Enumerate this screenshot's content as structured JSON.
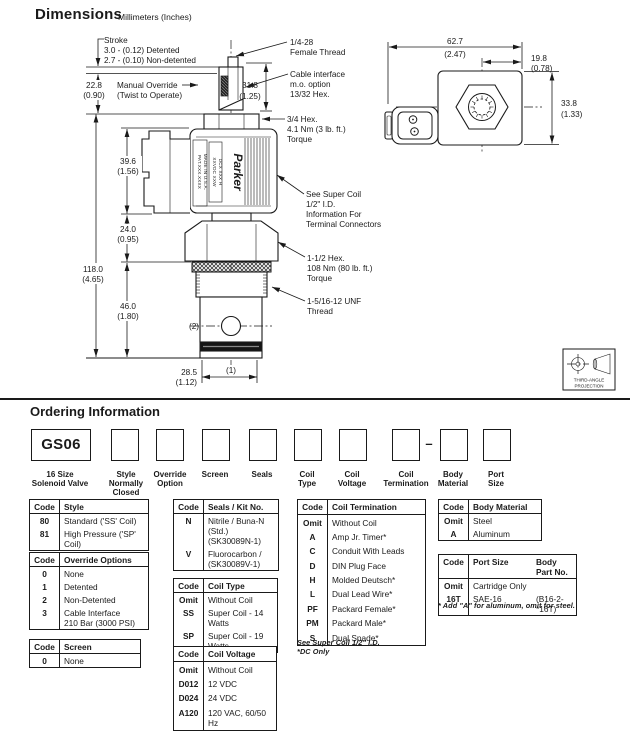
{
  "header": {
    "title": "Dimensions",
    "subtitle": "Millimeters (Inches)"
  },
  "diagram": {
    "stroke_lines": [
      "Stroke",
      "3.0 - (0.12) Detented",
      "2.7 - (0.10) Non-detented"
    ],
    "manual_override": [
      "Manual Override",
      "(Twist to Operate)"
    ],
    "dim_22_8": [
      "22.8",
      "(0.90)"
    ],
    "dim_118": [
      "118.0",
      "(4.65)"
    ],
    "dim_39_6": [
      "39.6",
      "(1.56)"
    ],
    "dim_24": [
      "24.0",
      "(0.95)"
    ],
    "dim_46": [
      "46.0",
      "(1.80)"
    ],
    "dim_31_8": [
      "31.8",
      "(1.25)"
    ],
    "dim_28_5": [
      "28.5",
      "(1.12)"
    ],
    "thread_callout": [
      "1/4-28",
      "Female Thread"
    ],
    "cable_callout": [
      "Cable interface",
      "m.o. option",
      "13/32 Hex."
    ],
    "hex34_callout": [
      "3/4 Hex.",
      "4.1 Nm (3 lb. ft.)",
      "Torque"
    ],
    "supercoil_callout": [
      "See Super Coil",
      "1/2\" I.D.",
      "Information For",
      "Terminal Connectors"
    ],
    "hex112_callout": [
      "1-1/2 Hex.",
      "108 Nm (80 lb. ft.)",
      "Torque"
    ],
    "unf_callout": [
      "1-5/16-12 UNF",
      "Thread"
    ],
    "port_1": "(1)",
    "port_2": "(2)",
    "coil_text": [
      "PAT.XXX.XXXX",
      "MADE IN U.S.A.",
      "XXVDC  XXW",
      "DCX XXX H"
    ],
    "brand": "Parker",
    "side_dim_62_7": [
      "62.7",
      "(2.47)"
    ],
    "side_dim_19_8": [
      "19.8",
      "(0.78)"
    ],
    "side_dim_33_8": [
      "33.8",
      "(1.33)"
    ],
    "projection": [
      "THIRD-ANGLE",
      "PROJECTION"
    ]
  },
  "ordering": {
    "title": "Ordering Information",
    "prefix": "GS06",
    "separator": "–",
    "fields": [
      {
        "lines": [
          "16 Size",
          "Solenoid Valve"
        ]
      },
      {
        "lines": [
          "Style",
          "Normally",
          "Closed"
        ]
      },
      {
        "lines": [
          "Override",
          "Option"
        ]
      },
      {
        "lines": [
          "Screen"
        ]
      },
      {
        "lines": [
          "Seals"
        ]
      },
      {
        "lines": [
          "Coil",
          "Type"
        ]
      },
      {
        "lines": [
          "Coil",
          "Voltage"
        ]
      },
      {
        "lines": [
          "Coil",
          "Termination"
        ]
      },
      {
        "lines": [
          "Body",
          "Material"
        ]
      },
      {
        "lines": [
          "Port",
          "Size"
        ]
      }
    ]
  },
  "tables": {
    "style": {
      "h": [
        "Code",
        "Style"
      ],
      "rows": [
        {
          "code": "80",
          "desc": "Standard ('SS' Coil)"
        },
        {
          "code": "81",
          "desc": "High Pressure ('SP' Coil)"
        }
      ]
    },
    "override": {
      "h": [
        "Code",
        "Override Options"
      ],
      "rows": [
        {
          "code": "0",
          "desc": "None"
        },
        {
          "code": "1",
          "desc": "Detented"
        },
        {
          "code": "2",
          "desc": "Non-Detented"
        },
        {
          "code": "3",
          "desc": "Cable Interface",
          "desc2": "210 Bar (3000 PSI)"
        }
      ]
    },
    "screen": {
      "h": [
        "Code",
        "Screen"
      ],
      "rows": [
        {
          "code": "0",
          "desc": "None"
        }
      ]
    },
    "seals": {
      "h": [
        "Code",
        "Seals / Kit No."
      ],
      "rows": [
        {
          "code": "N",
          "desc": "Nitrile / Buna-N (Std.)",
          "desc2": "(SK30089N-1)"
        },
        {
          "code": "V",
          "desc": "Fluorocarbon /",
          "desc2": "(SK30089V-1)"
        }
      ]
    },
    "coil_type": {
      "h": [
        "Code",
        "Coil Type"
      ],
      "rows": [
        {
          "code": "Omit",
          "desc": "Without Coil"
        },
        {
          "code": "SS",
          "desc": "Super Coil - 14 Watts"
        },
        {
          "code": "SP",
          "desc": "Super Coil - 19 Watts"
        }
      ]
    },
    "coil_voltage": {
      "h": [
        "Code",
        "Coil Voltage"
      ],
      "rows": [
        {
          "code": "Omit",
          "desc": "Without Coil"
        },
        {
          "code": "D012",
          "desc": "12 VDC"
        },
        {
          "code": "D024",
          "desc": "24 VDC"
        },
        {
          "code": "A120",
          "desc": "120 VAC, 60/50 Hz"
        }
      ]
    },
    "coil_termination": {
      "h": [
        "Code",
        "Coil Termination"
      ],
      "rows": [
        {
          "code": "Omit",
          "desc": "Without Coil"
        },
        {
          "code": "A",
          "desc": "Amp Jr. Timer*"
        },
        {
          "code": "C",
          "desc": "Conduit With Leads"
        },
        {
          "code": "D",
          "desc": "DIN Plug Face"
        },
        {
          "code": "H",
          "desc": "Molded Deutsch*"
        },
        {
          "code": "L",
          "desc": "Dual Lead Wire*"
        },
        {
          "code": "PF",
          "desc": "Packard Female*"
        },
        {
          "code": "PM",
          "desc": "Packard Male*"
        },
        {
          "code": "S",
          "desc": "Dual Spade*"
        }
      ],
      "footnotes": [
        "See Super Coil 1/2\" I.D.",
        "*DC Only"
      ]
    },
    "body_material": {
      "h": [
        "Code",
        "Body Material"
      ],
      "rows": [
        {
          "code": "Omit",
          "desc": "Steel"
        },
        {
          "code": "A",
          "desc": "Aluminum"
        }
      ]
    },
    "port_size": {
      "h": [
        "Code",
        "Port Size",
        "Body Part No."
      ],
      "rows": [
        {
          "code": "Omit",
          "desc": "Cartridge Only"
        },
        {
          "code": "16T",
          "desc": "SAE-16",
          "part": "(B16-2-*16T)"
        }
      ],
      "footnote": "* Add \"A\" for aluminum, omit for steel."
    }
  }
}
